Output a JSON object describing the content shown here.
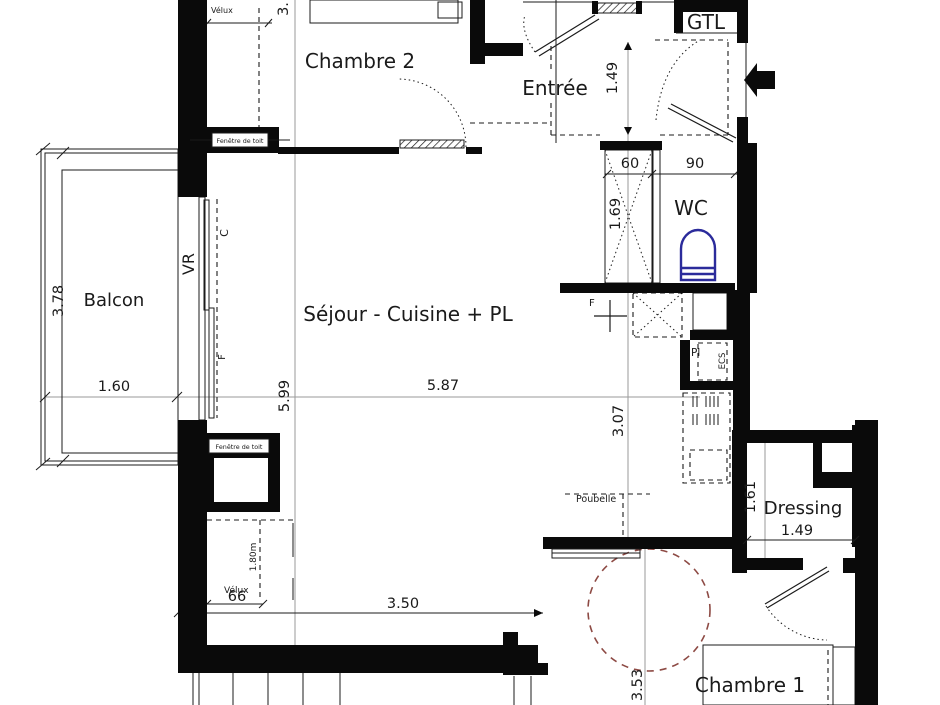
{
  "plan": {
    "rooms": {
      "chambre2": "Chambre 2",
      "entree": "Entrée",
      "gtl": "GTL",
      "wc": "WC",
      "balcon": "Balcon",
      "sejour": "Séjour - Cuisine + PL",
      "dressing": "Dressing",
      "chambre1": "Chambre 1"
    },
    "dims": {
      "top_cut": "3.",
      "entree_h": "1.49",
      "closet_w": "60",
      "wc_w": "90",
      "closet_h": "1.69",
      "balcon_h": "3.78",
      "balcon_w": "1.60",
      "sejour_h": "5.99",
      "sejour_w": "5.87",
      "cuisine_h": "3.07",
      "velux_w": "66",
      "sejour_bas_w": "3.50",
      "hall_h": "3.53",
      "dressing_h": "1.61",
      "dressing_w": "1.49"
    },
    "labels": {
      "velux_top": "Vélux",
      "velux_bottom": "Vélux",
      "fenetre_toit_top": "Fenêtre de toit",
      "fenetre_toit_bottom": "Fenêtre de toit",
      "vr": "VR",
      "c": "C",
      "f_window": "F",
      "f_wall": "F",
      "h180": "1.80m",
      "pl": "Pl",
      "ecs": "ECS",
      "poubelle": "Poubelle"
    },
    "colors": {
      "wall": "#0a0a0a",
      "line": "#1b1b1b",
      "ref_line": "#9a9a9a",
      "toilet": "#2b2b9b",
      "turning_circle": "#8d4a44"
    }
  }
}
